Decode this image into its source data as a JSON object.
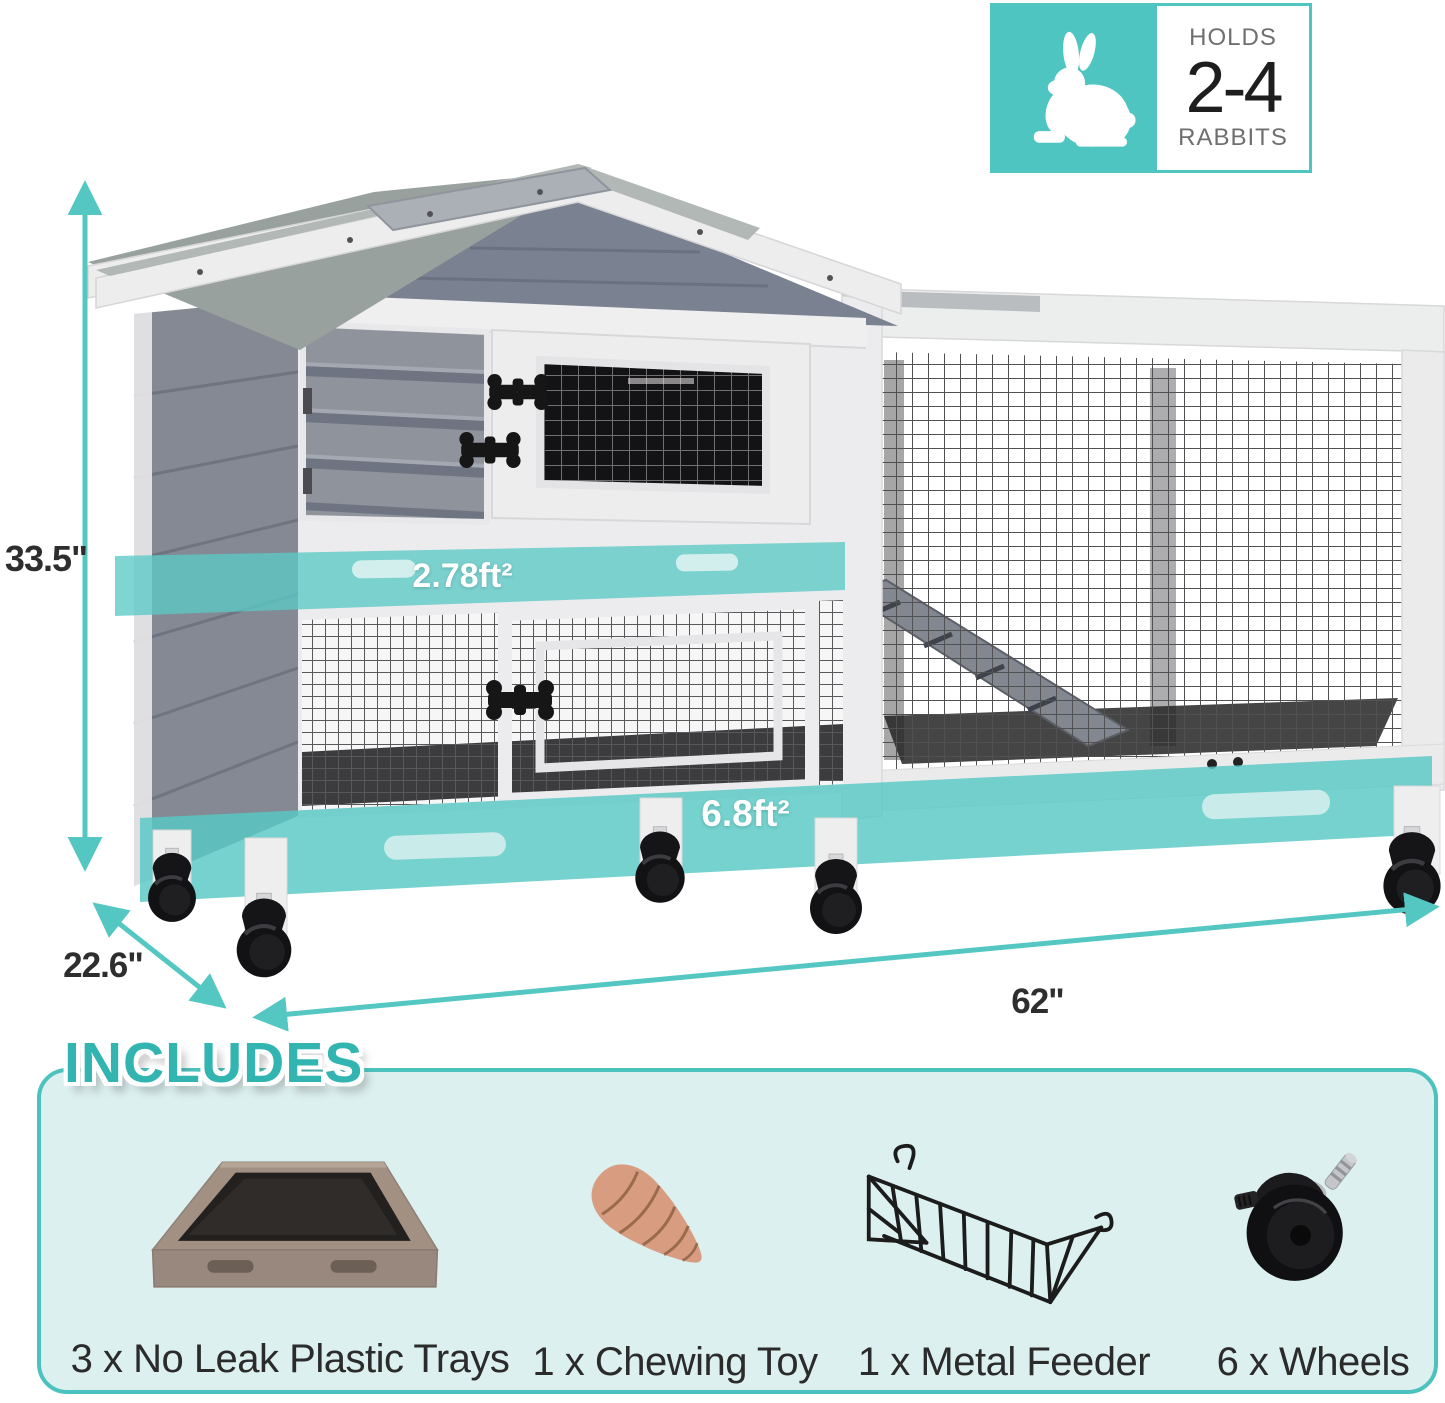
{
  "badge": {
    "holds": "HOLDS",
    "capacity": "2-4",
    "animal": "RABBITS",
    "icon": "rabbit-icon"
  },
  "dimensions": {
    "height": "33.5\"",
    "depth": "22.6\"",
    "length": "62\""
  },
  "areas": {
    "upper_level": "2.78ft²",
    "lower_level": "6.8ft²"
  },
  "includes": {
    "title": "INCLUDES",
    "items": [
      {
        "label": "3 x No Leak Plastic Trays",
        "icon": "litter-tray-icon"
      },
      {
        "label": "1 x Chewing Toy",
        "icon": "carrot-chew-toy-icon"
      },
      {
        "label": "1 x Metal Feeder",
        "icon": "metal-feeder-icon"
      },
      {
        "label": "6 x Wheels",
        "icon": "caster-wheel-icon"
      }
    ]
  },
  "colors": {
    "accent_teal": "#4ec5c1",
    "band_teal": "#5bc9c5",
    "panel_background": "#dcf0ef",
    "title_teal": "#32b4b0",
    "label_text": "#2b2b2b"
  }
}
